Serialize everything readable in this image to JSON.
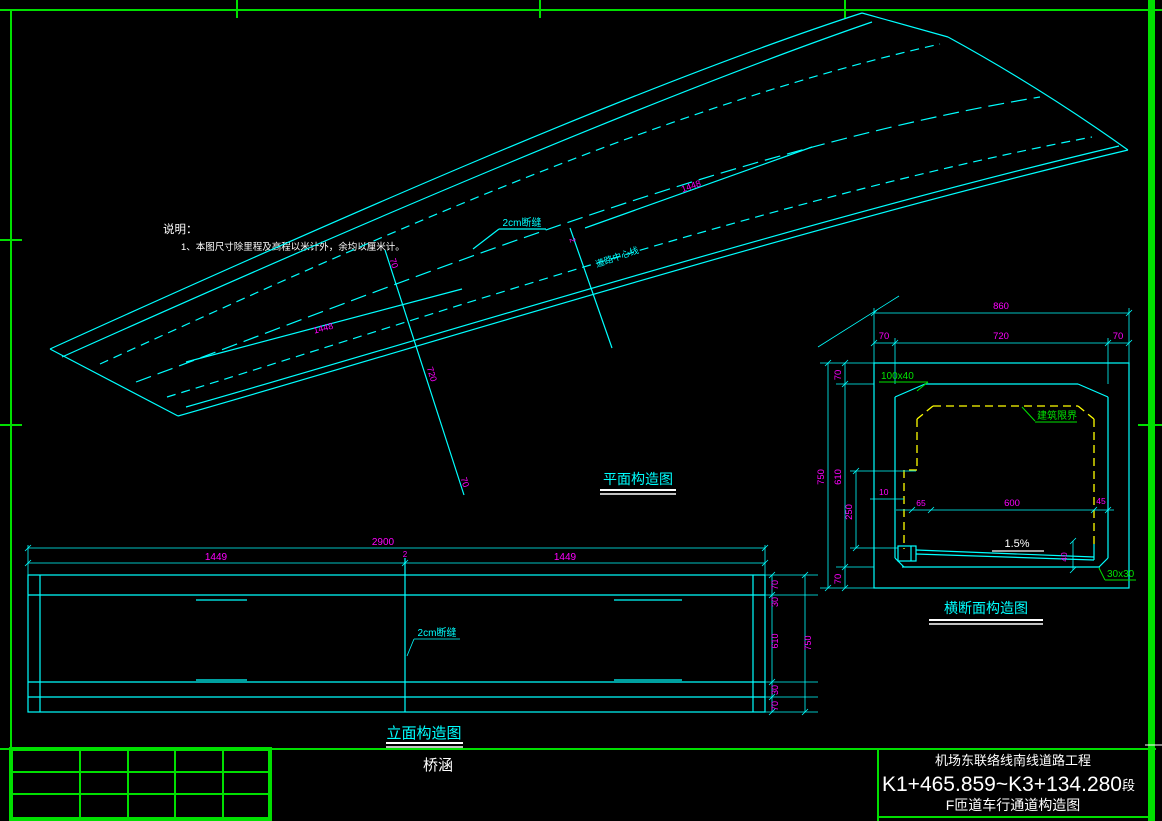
{
  "colors": {
    "background": "#000000",
    "line_cyan": "#00FFFF",
    "dim_magenta": "#FF00FF",
    "frame_green": "#00E400",
    "clearance_yellow": "#FFFF00",
    "text_white": "#FFFFFF"
  },
  "notes": {
    "heading": "说明：",
    "item1": "1、本图尺寸除里程及高程以米计外，余均以厘米计。"
  },
  "plan": {
    "title": "平面构造图",
    "joint_label": "2cm断缝",
    "centerline_label": "道路中心线",
    "dims": {
      "lower1448": "1448",
      "upper1448": "1448",
      "d720": "720",
      "d70a": "70",
      "d70b": "70",
      "d2": "2"
    }
  },
  "elevation": {
    "title": "立面构造图",
    "joint_label": "2cm断缝",
    "dims": {
      "total": "2900",
      "left": "1449",
      "joint": "2",
      "right": "1449",
      "h70_top": "70",
      "h30_top": "30",
      "h610": "610",
      "h30_bot": "30",
      "h70_bot": "70",
      "overall": "750"
    }
  },
  "section": {
    "title": "横断面构造图",
    "dims": {
      "total": "860",
      "top": [
        "70",
        "720",
        "70"
      ],
      "left": [
        "70",
        "610",
        "70"
      ],
      "overall": "750",
      "v250": "250",
      "h10": "10",
      "h65": "65",
      "h600": "600",
      "h45": "45",
      "v40": "40"
    },
    "labels": {
      "chamfer_top": "100x40",
      "clearance": "建筑限界",
      "slope": "1.5%",
      "chamfer_bottom": "30x30"
    }
  },
  "titleblock": {
    "project": "机场东联络线南线道路工程",
    "stake": "K1+465.859~K3+134.280",
    "stake_suffix": "段",
    "drawing": "F匝道车行通道构造图",
    "category": "桥涵"
  }
}
